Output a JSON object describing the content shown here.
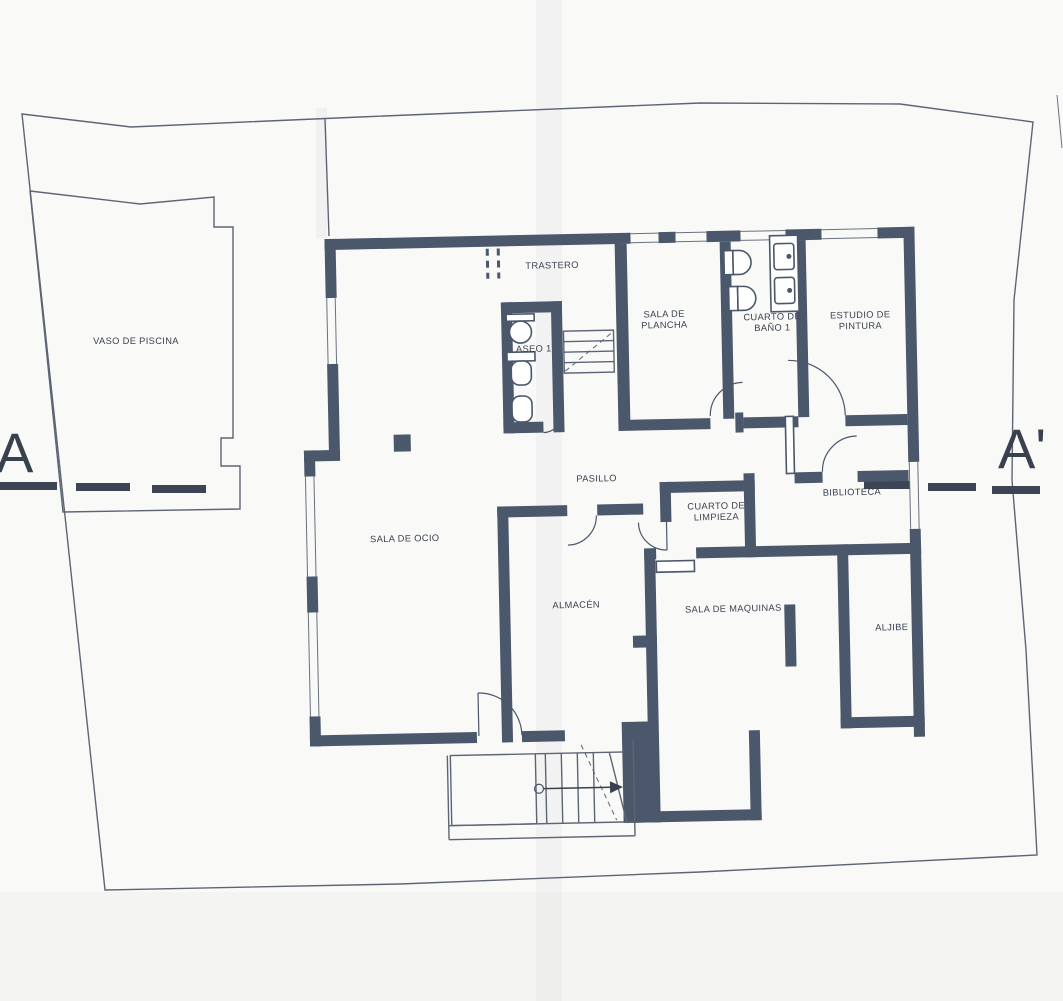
{
  "drawing": {
    "kind_visible_text_only": true,
    "section_markers": {
      "left": "A",
      "right": "A'"
    }
  },
  "rooms": [
    {
      "id": "vaso-de-piscina",
      "lines": [
        "VASO DE PISCINA"
      ]
    },
    {
      "id": "trastero",
      "lines": [
        "TRASTERO"
      ]
    },
    {
      "id": "aseo-1",
      "lines": [
        "ASEO 1"
      ]
    },
    {
      "id": "sala-de-plancha",
      "lines": [
        "SALA DE",
        "PLANCHA"
      ]
    },
    {
      "id": "cuarto-de-bano-1",
      "lines": [
        "CUARTO DE",
        "BAÑO 1"
      ]
    },
    {
      "id": "estudio-de-pintura",
      "lines": [
        "ESTUDIO DE",
        "PINTURA"
      ]
    },
    {
      "id": "pasillo",
      "lines": [
        "PASILLO"
      ]
    },
    {
      "id": "cuarto-de-limpieza",
      "lines": [
        "CUARTO DE",
        "LIMPIEZA"
      ]
    },
    {
      "id": "biblioteca",
      "lines": [
        "BIBLIOTECA"
      ]
    },
    {
      "id": "sala-de-ocio",
      "lines": [
        "SALA DE OCIO"
      ]
    },
    {
      "id": "almacen",
      "lines": [
        "ALMACÉN"
      ]
    },
    {
      "id": "sala-de-maquinas",
      "lines": [
        "SALA DE MAQUINAS"
      ]
    },
    {
      "id": "aljibe",
      "lines": [
        "ALJIBE"
      ]
    }
  ],
  "symbols": [
    "toilet-symbol",
    "bidet-symbol",
    "sink-symbol",
    "vanity-sinks-symbol",
    "stair-symbol",
    "stair-direction-arrow",
    "column-symbol",
    "door-swing-symbol",
    "section-line-dashes",
    "window-opening"
  ],
  "colors": {
    "wall": "#4b576b",
    "line": "#5d6575",
    "ink": "#39414f",
    "paper": "#f9f9f7"
  }
}
